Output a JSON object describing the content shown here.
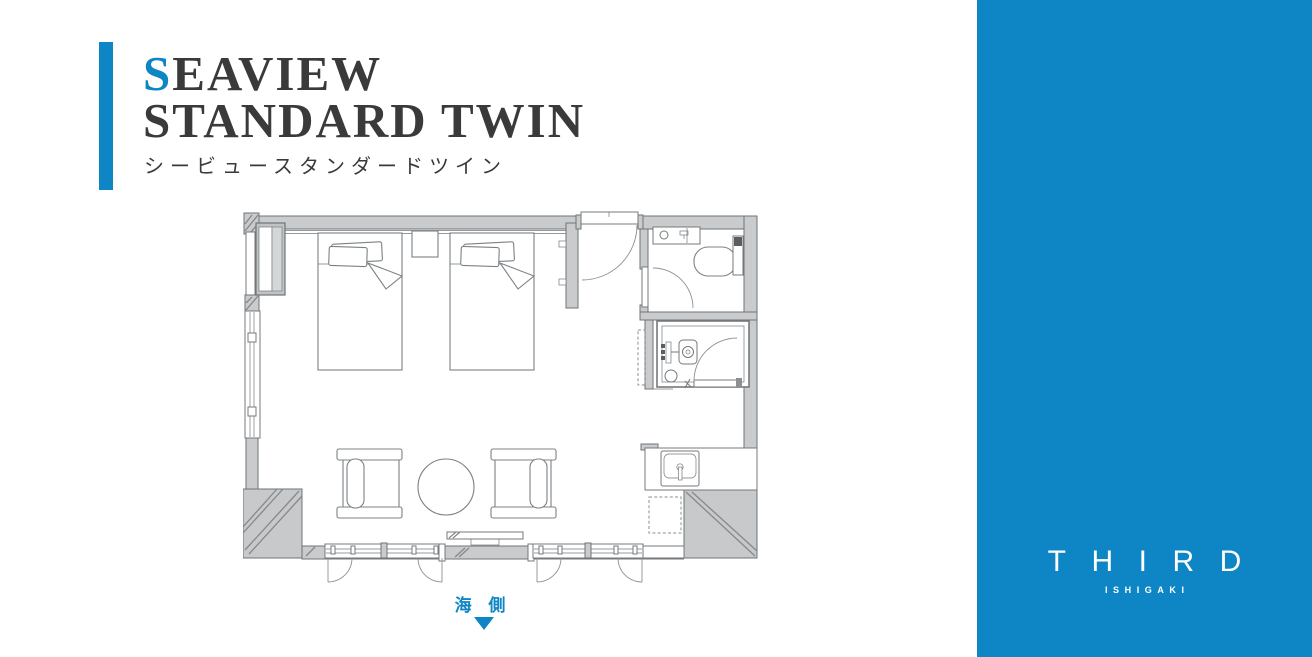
{
  "title": {
    "accent_letter": "S",
    "line1_rest": "EAVIEW",
    "line2": "STANDARD TWIN",
    "subtitle": "シービュースタンダードツイン"
  },
  "floor_plan": {
    "orientation_label": "海 側"
  },
  "brand": {
    "name": "THIRD",
    "location": "ISHIGAKI"
  },
  "colors": {
    "accent": "#0e86c5",
    "panel": "#0e86c5",
    "heading": "#3a3a3a",
    "wall_fill": "#c9cbcc",
    "wall_line": "#6f7478",
    "plan_line": "#75797c",
    "column_fill": "#c7c9ca",
    "hatch": "#85898c"
  }
}
